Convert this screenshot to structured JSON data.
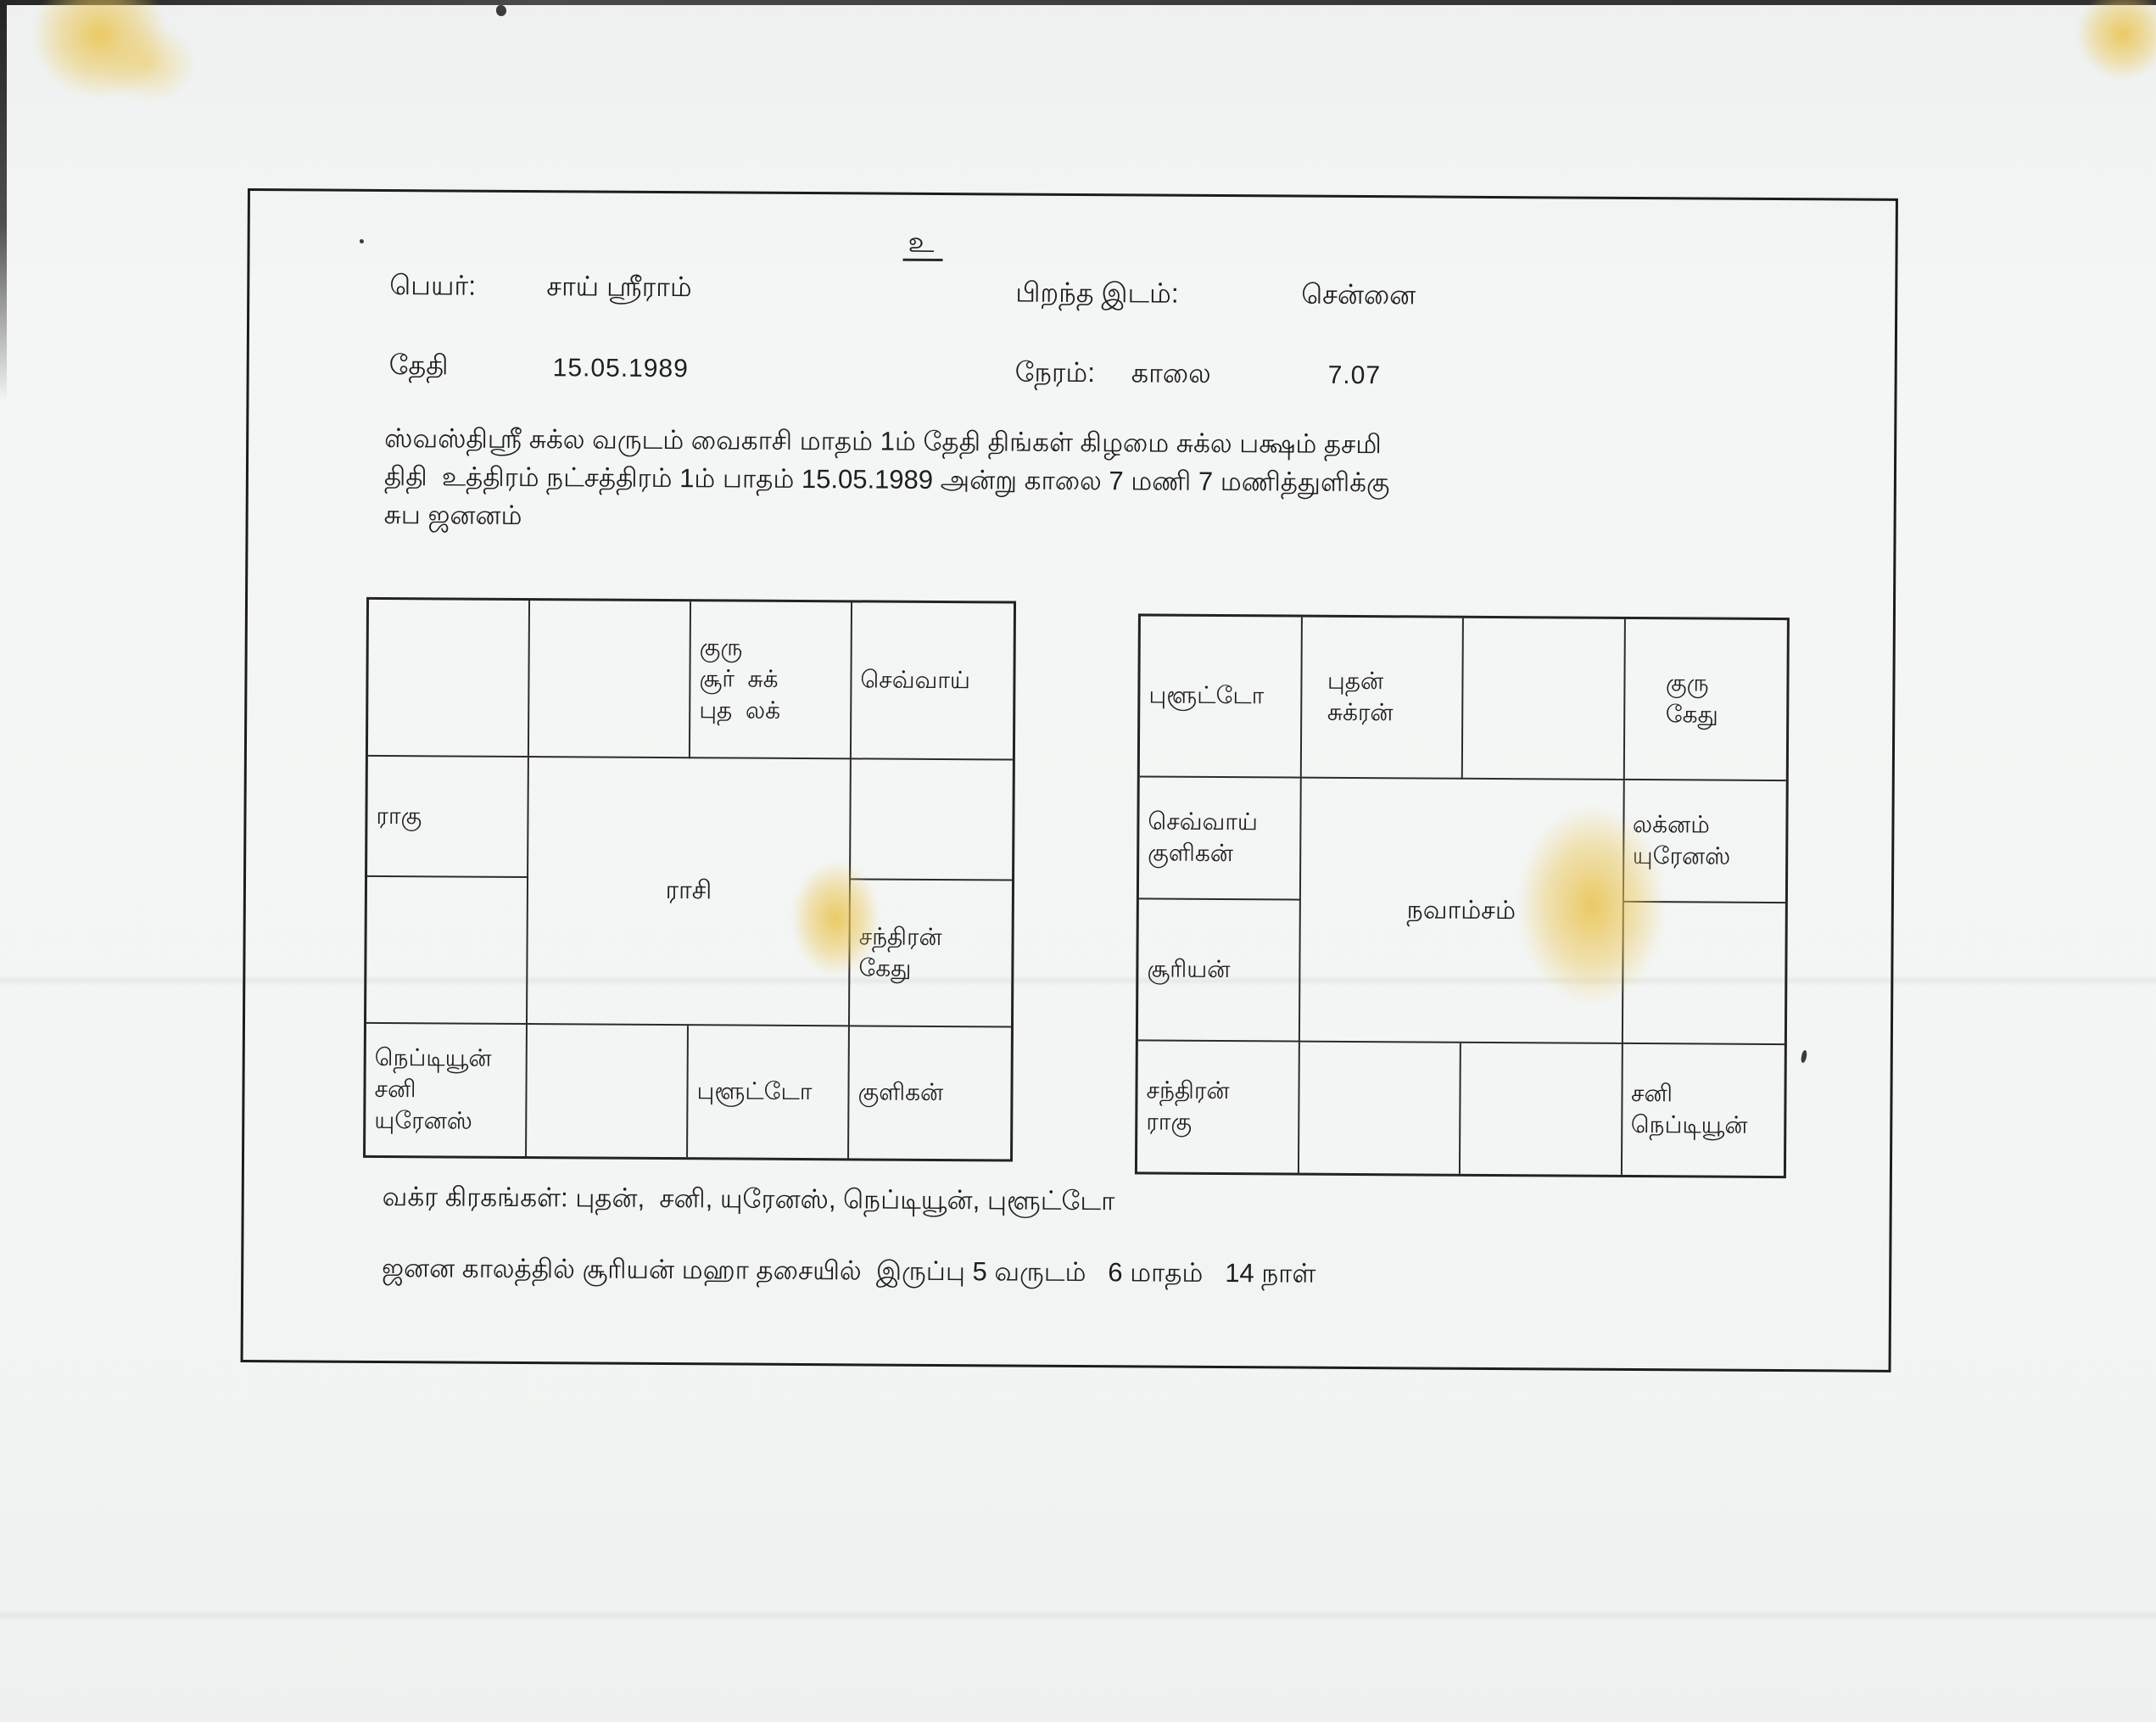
{
  "document": {
    "auspicious_mark": "உ",
    "header": {
      "name_label": "பெயர்:",
      "name_value": "சாய் ஸ்ரீராம்",
      "birthplace_label": "பிறந்த இடம்:",
      "birthplace_value": "சென்னை",
      "date_label": "தேதி",
      "date_value": "15.05.1989",
      "time_label": "நேரம்:",
      "time_meridiem": "காலை",
      "time_value": "7.07"
    },
    "intro": {
      "line1": "ஸ்வஸ்திஸ்ரீ சுக்ல வருடம் வைகாசி மாதம் 1ம் தேதி திங்கள் கிழமை சுக்ல பக்ஷம் தசமி",
      "line2": "திதி  உத்திரம் நட்சத்திரம் 1ம் பாதம் 15.05.1989 அன்று காலை 7 மணி 7 மணித்துளிக்கு",
      "line3": "சுப ஜனனம்"
    },
    "rasi_chart": {
      "title": "ராசி",
      "cells": {
        "r0c2": [
          "குரு",
          "சூர்  சுக்",
          "புத  லக்"
        ],
        "r0c3": [
          "செவ்வாய்"
        ],
        "r1c0": [
          "ராகு"
        ],
        "r2c3": [
          "சந்திரன்",
          "கேது"
        ],
        "r3c0": [
          "நெப்டியூன்",
          "சனி",
          "யுரேனஸ்"
        ],
        "r3c2": [
          "புளூட்டோ"
        ],
        "r3c3": [
          "குளிகன்"
        ]
      }
    },
    "navamsam_chart": {
      "title": "நவாம்சம்",
      "cells": {
        "r0c0": [
          "புளூட்டோ"
        ],
        "r0c1": [
          "புதன்",
          "சுக்ரன்"
        ],
        "r0c3": [
          "குரு",
          "கேது"
        ],
        "r1c0": [
          "செவ்வாய்",
          "குளிகன்"
        ],
        "r1c3": [
          "லக்னம்",
          "யுரேனஸ்"
        ],
        "r2c0": [
          "சூரியன்"
        ],
        "r3c0": [
          "சந்திரன்",
          "ராகு"
        ],
        "r3c3": [
          "சனி",
          "நெப்டியூன்"
        ]
      }
    },
    "footer": {
      "retrograde_line": "வக்ர கிரகங்கள்: புதன்,  சனி, யுரேனஸ், நெப்டியூன், புளூட்டோ",
      "dasa_line": "ஜனன காலத்தில் சூரியன் மஹா தசையில்  இருப்பு 5 வருடம்   6 மாதம்   14 நாள்"
    },
    "stain_color": "#ecc75e"
  }
}
